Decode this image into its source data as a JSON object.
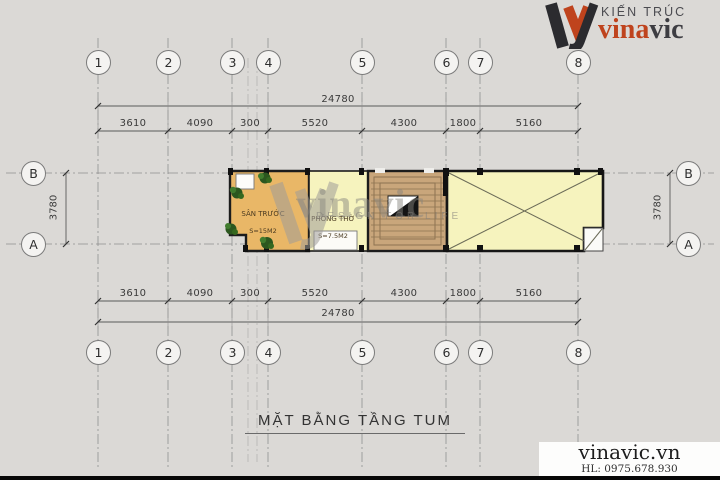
{
  "page": {
    "background": "#dbd9d6"
  },
  "logo": {
    "tagline": "KIẾN TRÚC",
    "brand_red": "vina",
    "brand_dark": "vic",
    "accent_color": "#bf431d",
    "dark_color": "#3d3d42"
  },
  "grid": {
    "columns": [
      "1",
      "2",
      "3",
      "4",
      "5",
      "6",
      "7",
      "8"
    ],
    "rows": [
      "B",
      "A"
    ]
  },
  "dimensions": {
    "overall": "24780",
    "segments": [
      "3610",
      "4090",
      "300",
      "5520",
      "4300",
      "1800",
      "5160"
    ],
    "vertical": "3780"
  },
  "plan": {
    "rooms": [
      {
        "label": "SÂN TRƯỚC",
        "area": "S=15M2",
        "color": "#e9b767"
      },
      {
        "label": "PHÒNG THỜ",
        "area": "S=7.5M2",
        "color": "#f6f3be"
      }
    ],
    "stairs_color": "#c9a67b",
    "roof_color": "#f6f3be"
  },
  "watermark": {
    "brand": "vinavic",
    "tagline": "DESIGN FOR LIFE"
  },
  "title": "MẶT BẰNG TẦNG TUM",
  "footer": {
    "website": "vinavic.vn",
    "hotline": "HL: 0975.678.930"
  }
}
